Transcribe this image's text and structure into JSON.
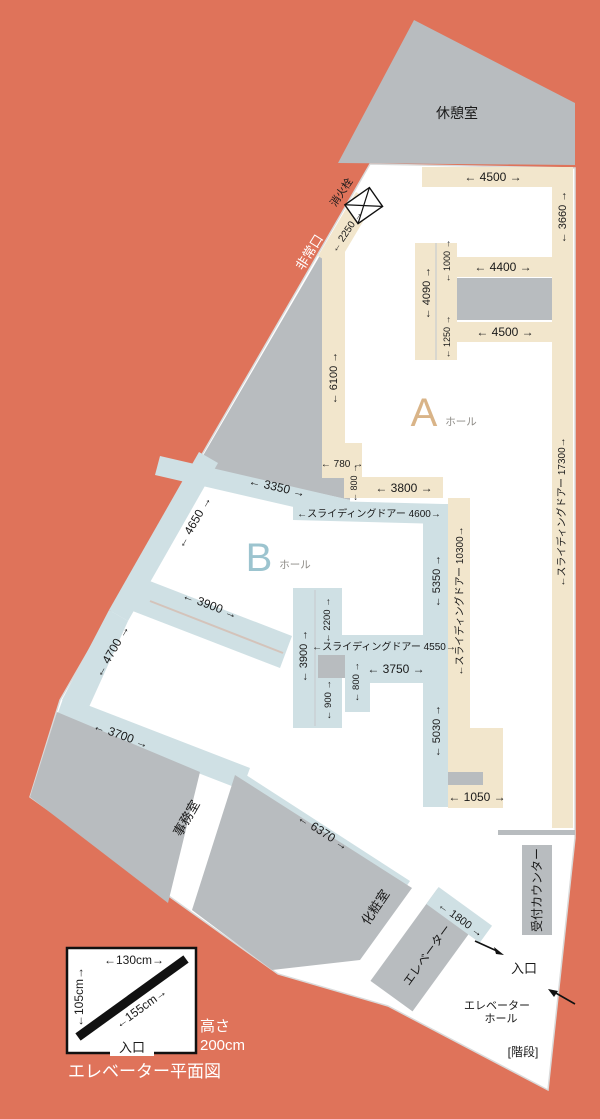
{
  "colors": {
    "background_coral": "#df735a",
    "floor_white": "#ffffff",
    "room_gray": "#b8bcbf",
    "corridor_a_beige": "#f2e6cc",
    "corridor_b_blue": "#cfe0e4",
    "ink": "#1a1a1a",
    "hall_a_letter": "#d9b488",
    "hall_b_letter": "#9cc4cf"
  },
  "rooms": {
    "rest_room": "休憩室",
    "office": "事務室",
    "powder_room": "化粧室",
    "elevator": "エレベーター",
    "reception_counter": "受付カウンター"
  },
  "halls": {
    "a_letter": "A",
    "a_suffix": "ホール",
    "b_letter": "B",
    "b_suffix": "ホール"
  },
  "labels": {
    "emergency_exit": "非常口",
    "fire_hydrant": "消火栓",
    "entrance": "入口",
    "elevator_hall_line1": "エレベーター",
    "elevator_hall_line2": "ホール",
    "stairs": "[階段]"
  },
  "dims": {
    "d4500_top": "← 4500 →",
    "d3660": "← 3660 →",
    "d2250": "← 2250 →",
    "d1000": "← 1000 →",
    "d4400": "← 4400 →",
    "d4090": "← 4090 →",
    "d1250": "← 1250 →",
    "d4500_mid": "← 4500 →",
    "d6100": "← 6100 →",
    "d17300": "←スライディングドアー 17300→",
    "d780": "← 780 →",
    "d800_a": "← 800 →",
    "d3800": "← 3800 →",
    "d4600": "←スライディングドアー 4600→",
    "d3350": "← 3350 →",
    "d4650": "← 4650 →",
    "d5350": "← 5350 →",
    "d10300": "←スライディングドアー 10300→",
    "d3900_diag": "← 3900 →",
    "d2200": "← 2200 →",
    "d3900_vert": "← 3900 →",
    "d4700": "← 4700 →",
    "d4550": "←スライディングドアー 4550→",
    "d3750": "← 3750 →",
    "d800_b": "← 800 →",
    "d900": "← 900 →",
    "d3700": "← 3700 →",
    "d5030": "← 5030 →",
    "d6370": "← 6370 →",
    "d1050": "← 1050 →",
    "d1800": "← 1800 →"
  },
  "legend": {
    "width": "←130cm→",
    "depth": "←105cm→",
    "diagonal": "←155cm→",
    "entrance": "入口",
    "height_line1": "高さ",
    "height_line2": "200cm",
    "caption": "エレベーター平面図"
  }
}
